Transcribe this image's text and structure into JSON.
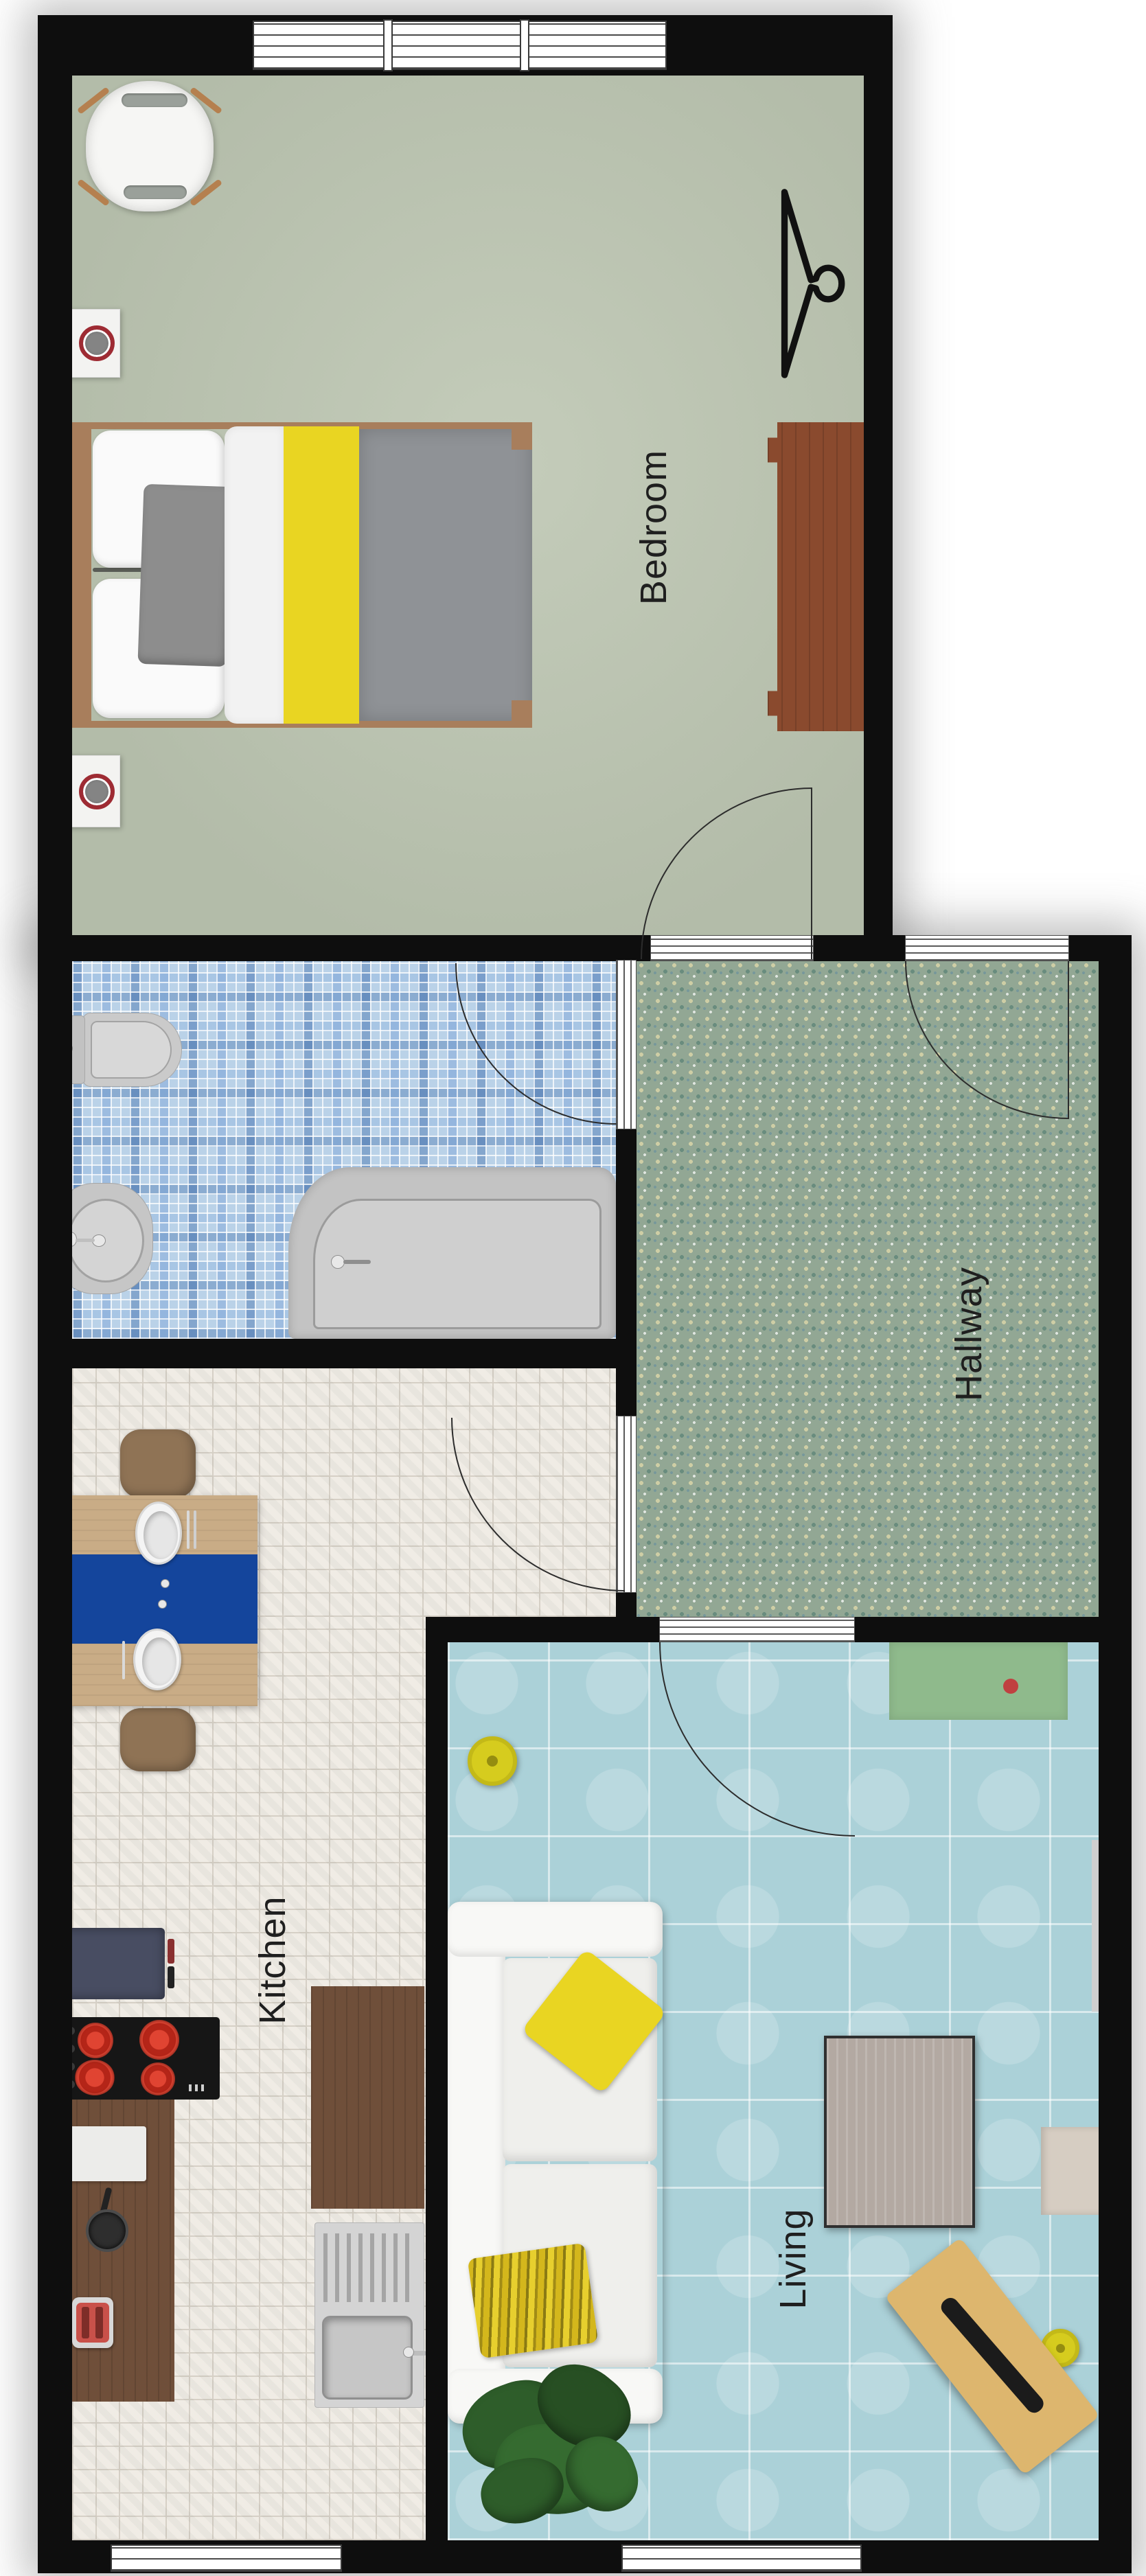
{
  "rooms": {
    "bedroom": {
      "label": "Bedroom"
    },
    "hallway": {
      "label": "Hallway"
    },
    "kitchen": {
      "label": "Kitchen"
    },
    "living": {
      "label": "Living"
    }
  },
  "palette": {
    "wall": "#0e0e0e",
    "bedroom_floor": "#b3bca9",
    "bedroom_floor_light": "#c4ccba",
    "bathroom_floor": "#bad2e8",
    "hallway_floor": "#92a794",
    "kitchen_floor": "#f0ece5",
    "living_floor": "#abd1d8",
    "accent_yellow": "#e9d522",
    "accent_blue": "#14459c",
    "wood_frame": "#a87e5c",
    "wood_leg": "#b5804f",
    "table_wood": "#c9ac86",
    "chair_wood": "#8f7355",
    "counter_wood": "#6f4f3a",
    "dresser_wood": "#8a4a2e",
    "appliance_dark": "#484d62",
    "toaster_red": "#c9514a",
    "stool_yellow": "#d6cc1e",
    "mat_green": "#8fba8c",
    "desk_tan": "#ddb66e",
    "dot_red": "#c04040"
  },
  "furniture": [
    {
      "room": "Bedroom",
      "item": "armchair"
    },
    {
      "room": "Bedroom",
      "item": "clothes-hanger-symbol"
    },
    {
      "room": "Bedroom",
      "item": "double-bed-yellow-gray"
    },
    {
      "room": "Bedroom",
      "item": "dresser"
    },
    {
      "room": "Bedroom",
      "item": "wall-speaker-unit"
    },
    {
      "room": "Bedroom",
      "item": "wall-speaker-unit"
    },
    {
      "room": "Bathroom",
      "item": "toilet"
    },
    {
      "room": "Bathroom",
      "item": "bidet"
    },
    {
      "room": "Bathroom",
      "item": "bathtub"
    },
    {
      "room": "Kitchen",
      "item": "dining-table-blue-runner-two-plates"
    },
    {
      "room": "Kitchen",
      "item": "dining-chair"
    },
    {
      "room": "Kitchen",
      "item": "dining-chair"
    },
    {
      "room": "Kitchen",
      "item": "refrigerator"
    },
    {
      "room": "Kitchen",
      "item": "cooktop-four-red-burners"
    },
    {
      "room": "Kitchen",
      "item": "counter-with-board-pot-toaster"
    },
    {
      "room": "Kitchen",
      "item": "island-counter"
    },
    {
      "room": "Kitchen",
      "item": "sink-unit-with-drainboard"
    },
    {
      "room": "Living",
      "item": "white-sofa-yellow-pillows"
    },
    {
      "room": "Living",
      "item": "yellow-round-stool"
    },
    {
      "room": "Living",
      "item": "green-doormat-red-dot"
    },
    {
      "room": "Living",
      "item": "coffee-table"
    },
    {
      "room": "Living",
      "item": "side-bench"
    },
    {
      "room": "Living",
      "item": "diagonal-desk-with-laptop"
    },
    {
      "room": "Living",
      "item": "potted-plant"
    },
    {
      "room": "Living",
      "item": "small-yellow-disc"
    },
    {
      "room": "Living",
      "item": "wall-radiator"
    }
  ],
  "openings": {
    "doors": [
      "bedroom-door",
      "entry-door",
      "bathroom-door",
      "kitchen-door",
      "living-door"
    ],
    "windows": [
      "bedroom-window-3-pane",
      "kitchen-window",
      "living-window"
    ]
  }
}
